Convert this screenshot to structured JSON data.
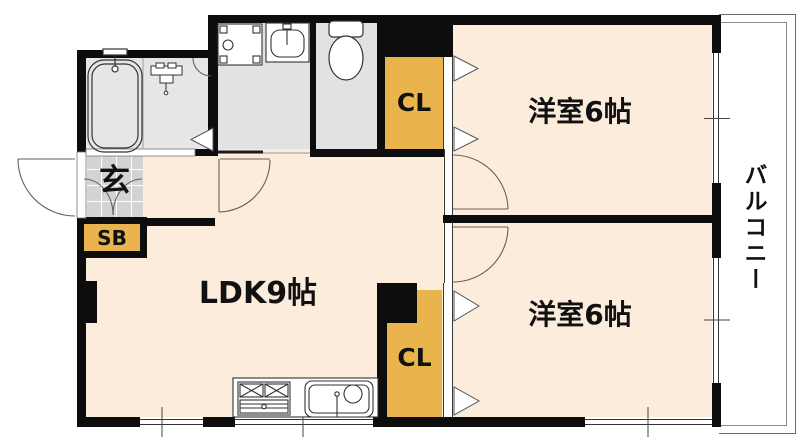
{
  "plan_type": "apartment-floor-plan",
  "rooms": {
    "ldk": {
      "label": "LDK9帖"
    },
    "bedroom_top": {
      "label": "洋室6帖"
    },
    "bedroom_bottom": {
      "label": "洋室6帖"
    },
    "entrance": {
      "label": "玄"
    },
    "shoe_box": {
      "label": "SB"
    },
    "closet_top": {
      "label": "CL"
    },
    "closet_bottom": {
      "label": "CL"
    },
    "balcony": {
      "label": "バルコニー"
    }
  },
  "fixtures": {
    "bathtub": "bathtub",
    "washroom_faucet": "faucet",
    "washing_machine_pan": "washing-machine-pan",
    "vanity_sink": "vanity-sink",
    "toilet": "toilet",
    "stove": "gas-stove",
    "kitchen_sink": "kitchen-sink"
  },
  "colors": {
    "room_floor": "#fcecdc",
    "wet_floor": "#e6e6e8",
    "tile_floor": "#d3d3d6",
    "storage": "#e9b44c",
    "wall": "#0d0d0d",
    "outline": "#555555"
  }
}
